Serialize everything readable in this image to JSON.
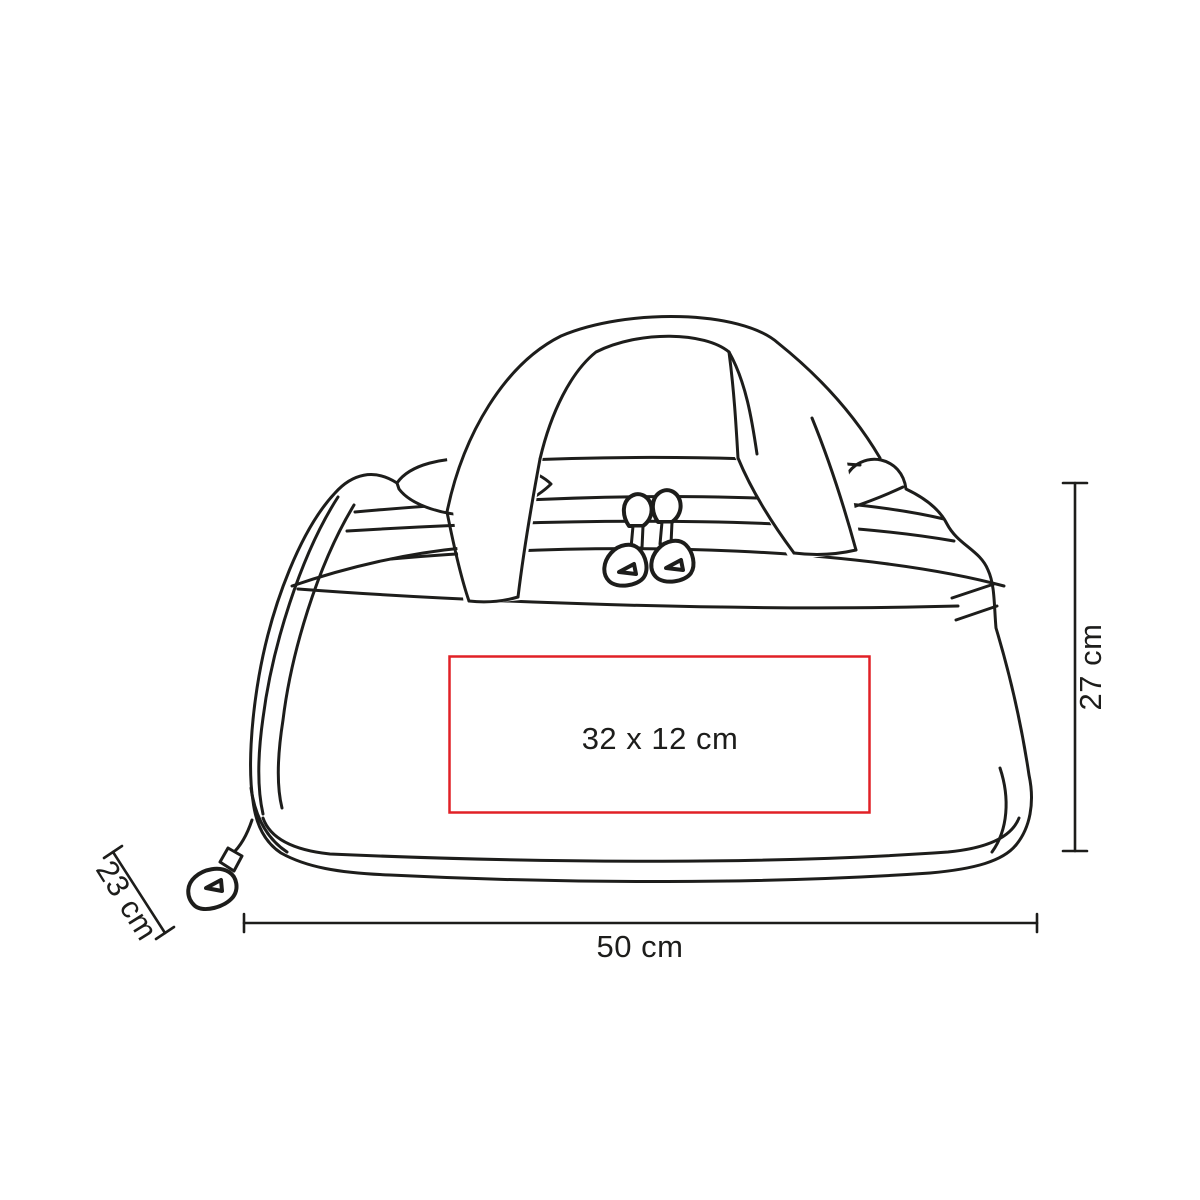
{
  "figure": {
    "name": "duffel-bag-line-drawing"
  },
  "print_area": {
    "label": "32 x 12 cm",
    "border_color": "#e12026"
  },
  "dimensions": {
    "width_label": "50 cm",
    "height_label": "27 cm",
    "depth_label": "23 cm"
  },
  "colors": {
    "line": "#1d1d1b",
    "accent_red": "#e12026",
    "background": "#ffffff"
  }
}
